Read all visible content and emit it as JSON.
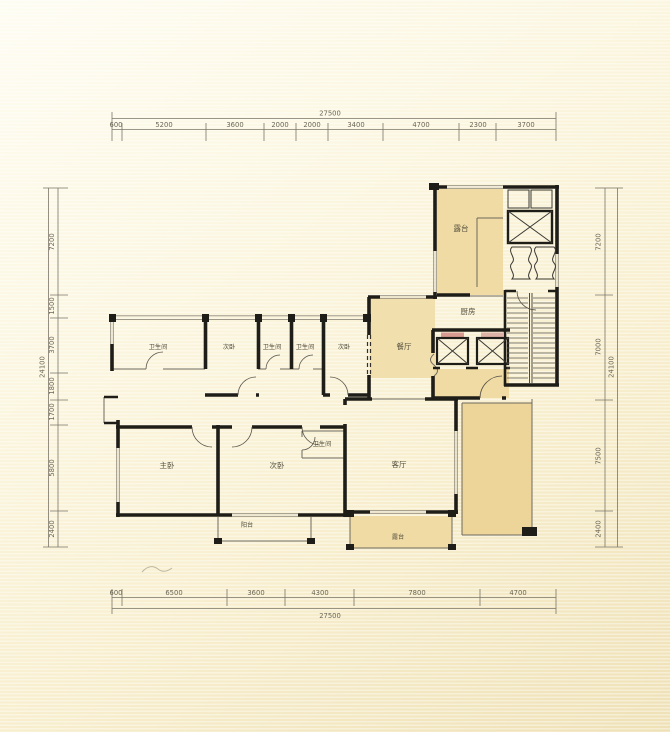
{
  "drawing": {
    "kind_note": "apartment floor plan",
    "colors": {
      "paper": "#f8efcf",
      "room_shade": "#f0dba4",
      "room_shade_deep": "#edd499",
      "wall": "#1f1d18",
      "dim_text": "#6b6656",
      "elevator_accent_left": "#d89b92",
      "elevator_accent_right": "#ddb3a8"
    }
  },
  "rooms": {
    "terrace_top": {
      "label": "露台"
    },
    "kitchen": {
      "label": "厨房"
    },
    "dining": {
      "label": "餐厅"
    },
    "bath_1": {
      "label": "卫生间"
    },
    "bed_1": {
      "label": "次卧"
    },
    "bath_2": {
      "label": "卫生间"
    },
    "bath_3": {
      "label": "卫生间"
    },
    "bed_2": {
      "label": "次卧"
    },
    "master": {
      "label": "主卧"
    },
    "bed_3": {
      "label": "次卧"
    },
    "bath_4": {
      "label": "卫生间"
    },
    "living": {
      "label": "客厅"
    },
    "balcony": {
      "label": "阳台"
    },
    "terrace_bottom": {
      "label": "露台"
    }
  },
  "dims": {
    "top": {
      "total": "27500",
      "segments": [
        "600",
        "5200",
        "3600",
        "2000",
        "2000",
        "3400",
        "4700",
        "2300",
        "3700"
      ]
    },
    "bottom": {
      "total": "27500",
      "segments": [
        "600",
        "6500",
        "3600",
        "4300",
        "7800",
        "4700"
      ]
    },
    "left": {
      "total": "24100",
      "segments": [
        "7200",
        "1500",
        "3700",
        "1800",
        "1700",
        "5800",
        "2400"
      ]
    },
    "right": {
      "total": "24100",
      "segments": [
        "7200",
        "7000",
        "7500",
        "2400"
      ]
    }
  }
}
